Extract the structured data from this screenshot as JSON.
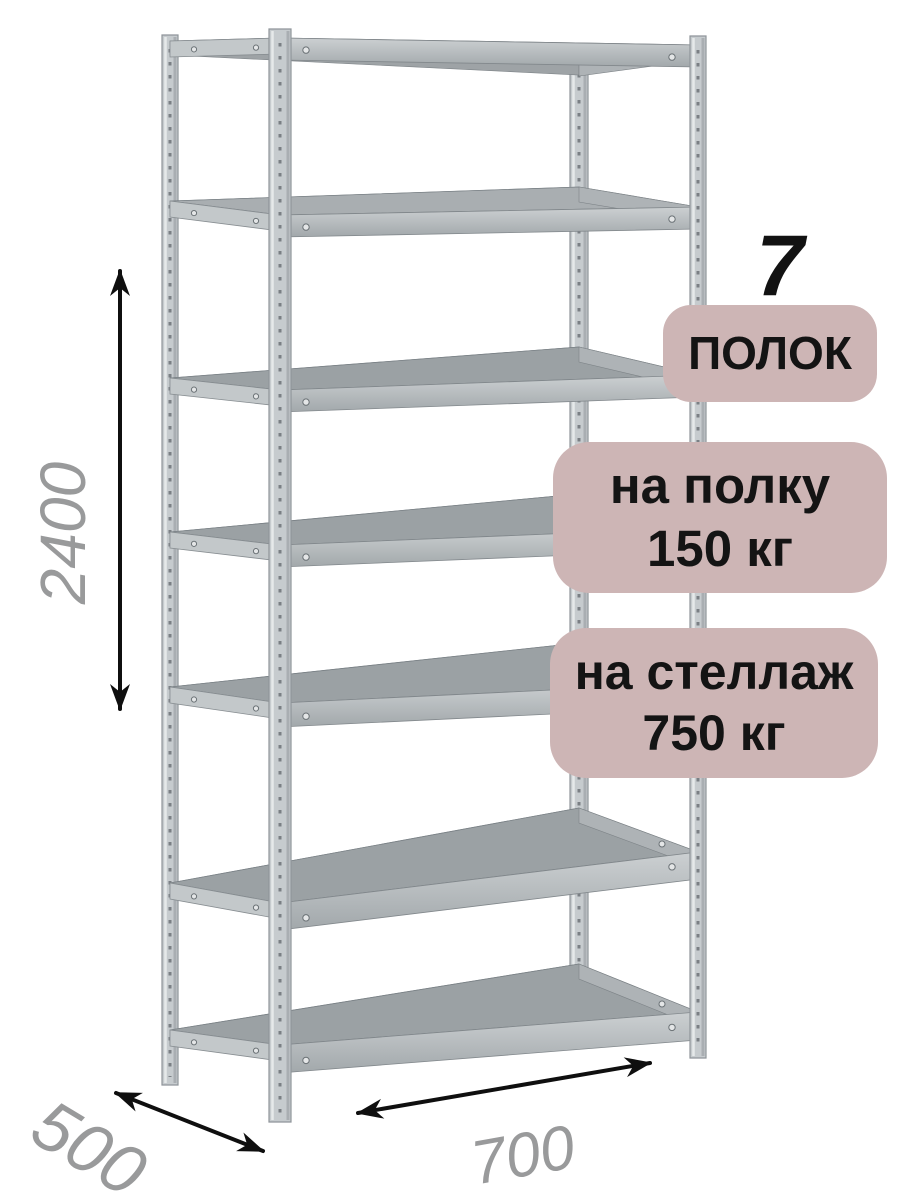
{
  "product": {
    "type": "metal-shelving-rack",
    "shelf_count": 7
  },
  "dimensions": {
    "height": "2400",
    "depth": "500",
    "width": "700"
  },
  "badges": {
    "shelf_count": {
      "number": "7",
      "label": "ПОЛОК"
    },
    "shelf_load": {
      "line1": "на полку",
      "line2": "150 кг"
    },
    "rack_load": {
      "line1": "на стеллаж",
      "line2": "750 кг"
    }
  },
  "colors": {
    "background": "#ffffff",
    "badge_bg": "#cdb5b5",
    "badge_text": "#141414",
    "dimension_text": "#999a9b",
    "arrow": "#0f0f0f",
    "post_fill": "#c6cbce",
    "post_edge": "#8f959a",
    "shelf_face": "#9ba1a4",
    "shelf_face_light": "#b9bec1",
    "beam_top": "#ccd0d2",
    "beam_bottom": "#a2a8ab",
    "back_beam": "#9ea3a6",
    "side_beam_left": "#c3c8ca",
    "side_beam_right": "#aeb3b6",
    "bolt": "#e4e6e7",
    "bolt_ring": "#6b7276"
  }
}
